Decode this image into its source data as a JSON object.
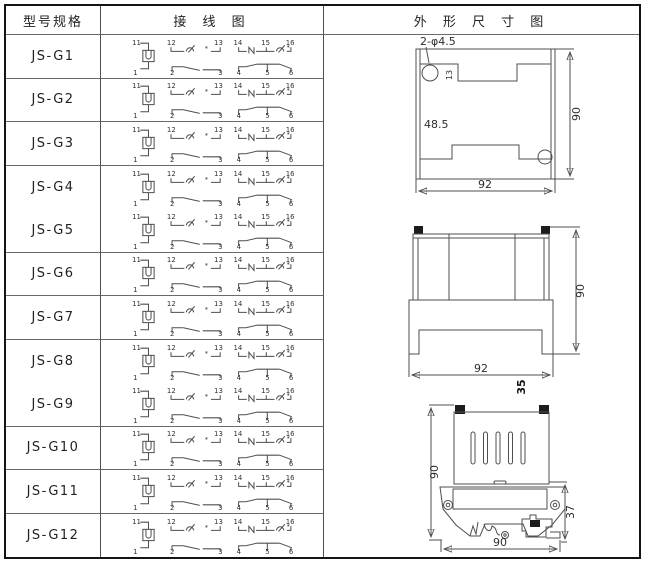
{
  "header": {
    "model_col": "型号规格",
    "wiring_col": "接 线 图",
    "outline_col": "外 形 尺 寸 图"
  },
  "models": [
    "JS-G1",
    "JS-G2",
    "JS-G3",
    "JS-G4",
    "JS-G5",
    "JS-G6",
    "JS-G7",
    "JS-G8",
    "JS-G9",
    "JS-G10",
    "JS-G11",
    "JS-G12"
  ],
  "wiring": {
    "top_terminals": [
      "11",
      "12",
      "13",
      "14",
      "15",
      "16"
    ],
    "bottom_terminals": [
      "1",
      "2",
      "3",
      "4",
      "5",
      "6"
    ],
    "asterisk": "*"
  },
  "outline": {
    "panel_cutout": {
      "holes_label": "2-φ4.5",
      "height": "90",
      "width": "92",
      "inner_offset": "48.5",
      "notch_depth": "13"
    },
    "front_view": {
      "height": "90",
      "width": "92",
      "depth": "35"
    },
    "side_view": {
      "height": "90",
      "width": "90",
      "rail_height": "37"
    }
  },
  "colors": {
    "line": "#4f4f4f",
    "border": "#141414",
    "text": "#222222"
  }
}
